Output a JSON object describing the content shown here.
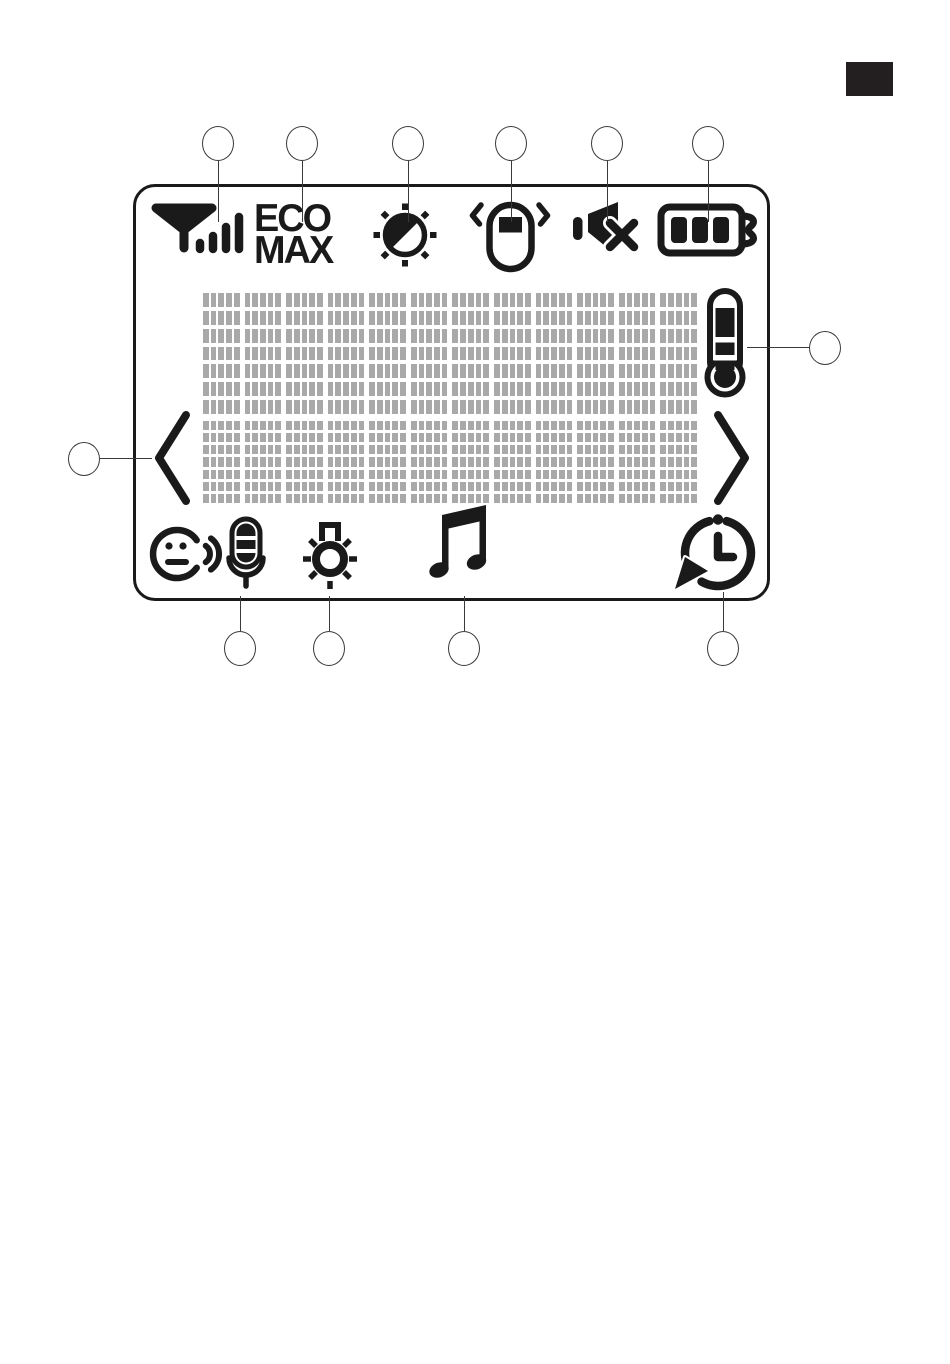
{
  "page": {
    "background_color": "#ffffff",
    "corner_tab": {
      "name": "page-corner-tab",
      "color": "#231f20"
    }
  },
  "display": {
    "name": "monitor-display-panel",
    "ink_color": "#1a1a1a",
    "eco_max": {
      "line1": "ECO",
      "line2": "MAX"
    },
    "status_icons_top": [
      {
        "name": "signal-strength-icon"
      },
      {
        "name": "eco-max-text"
      },
      {
        "name": "brightness-icon"
      },
      {
        "name": "vibration-icon"
      },
      {
        "name": "mute-icon"
      },
      {
        "name": "battery-icon"
      }
    ],
    "icons_bottom": [
      {
        "name": "voice-microphone-icon"
      },
      {
        "name": "nightlight-icon"
      },
      {
        "name": "lullaby-note-icon"
      },
      {
        "name": "feed-timer-icon"
      }
    ],
    "side_elements": [
      {
        "name": "left-arrow-icon"
      },
      {
        "name": "thermometer-icon"
      },
      {
        "name": "right-arrow-icon"
      }
    ],
    "pixel_grid": {
      "segment_color": "#a9a9a9",
      "character_columns": 12,
      "text_lines": 2,
      "cell_dot_columns": 5,
      "cell_dot_rows": 7
    }
  },
  "callouts": {
    "top": [
      {
        "target": "signal-strength-icon"
      },
      {
        "target": "eco-max-text"
      },
      {
        "target": "brightness-icon"
      },
      {
        "target": "vibration-icon"
      },
      {
        "target": "mute-icon"
      },
      {
        "target": "battery-icon"
      }
    ],
    "bottom": [
      {
        "target": "voice-microphone-icon"
      },
      {
        "target": "nightlight-icon"
      },
      {
        "target": "lullaby-note-icon"
      },
      {
        "target": "feed-timer-icon"
      }
    ],
    "left": {
      "target": "left-arrow-icon"
    },
    "right": {
      "target": "thermometer-icon"
    }
  }
}
